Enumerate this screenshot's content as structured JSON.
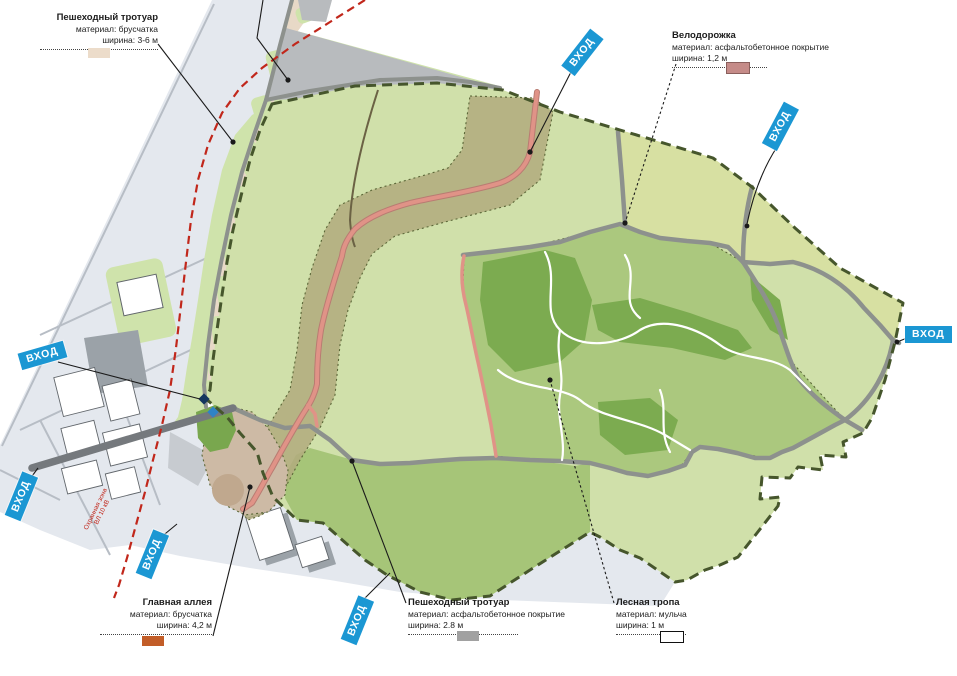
{
  "legend": {
    "items": [
      {
        "id": "pedestrian-pavers",
        "title": "Пешеходный тротуар",
        "material": "материал: брусчатка",
        "width": "ширина: 3-6 м",
        "swatch": "#ecdcca"
      },
      {
        "id": "bike-path",
        "title": "Велодорожка",
        "material": "материал: асфальтобетонное покрытие",
        "width": "ширина: 1,2 м",
        "swatch": "#c58b88"
      },
      {
        "id": "main-alley",
        "title": "Главная аллея",
        "material": "материал: брусчатка",
        "width": "ширина: 4,2 м",
        "swatch": "#c25d28"
      },
      {
        "id": "pedestrian-asphalt",
        "title": "Пешеходный тротуар",
        "material": "материал: асфальтобетонное покрытие",
        "width": "ширина: 2.8 м",
        "swatch": "#a1a1a1"
      },
      {
        "id": "forest-trail",
        "title": "Лесная тропа",
        "material": "материал: мульча",
        "width": "ширина: 1 м",
        "swatch": "#ffffff"
      }
    ]
  },
  "entrances": {
    "label": "ВХОД",
    "count": 7,
    "badge_color": "#1b97d3"
  },
  "annotations": {
    "power_line_zone": "Охранная зона ВЛ 10 кВ",
    "power_line_color": "#c1271b"
  },
  "map_colors": {
    "park_light_green": "#d0e0aa",
    "meadow_green": "#a6c578",
    "forest_green": "#7cab50",
    "ne_band_green": "#d7e0a2",
    "corridor_olive": "#b1aa7e",
    "promenade_beige": "#e8d9c7",
    "bike_path_pink": "#e09387",
    "road_gray": "#8d918d",
    "city_gray": "#e4e8ee",
    "boundary_olive": "#46562c",
    "tan_area": "#cdbaa5",
    "entrance_blue": "#1b97d3"
  }
}
